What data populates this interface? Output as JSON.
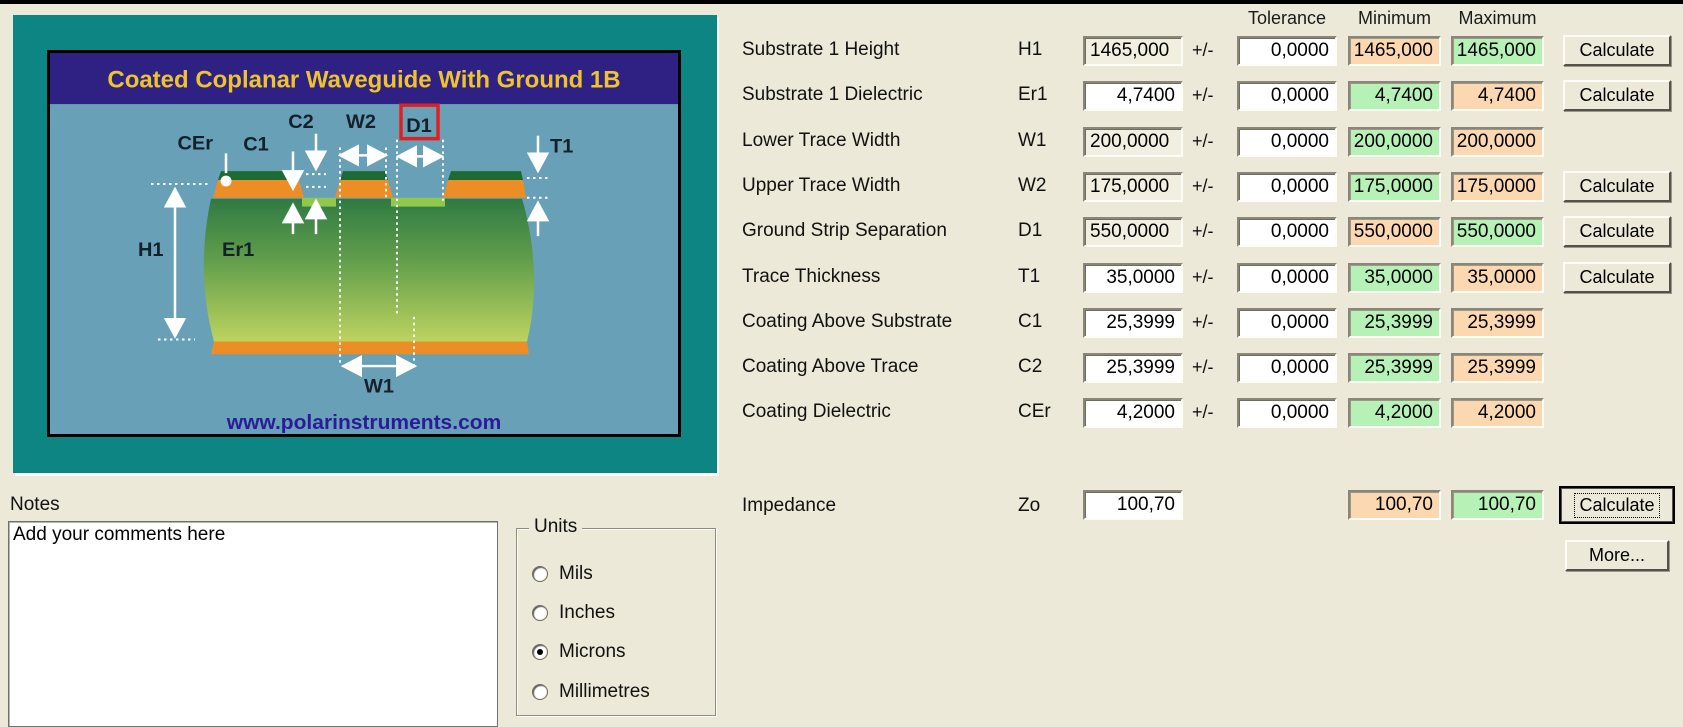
{
  "diagram": {
    "title": "Coated Coplanar Waveguide With Ground 1B",
    "website": "www.polarinstruments.com",
    "labels": {
      "cer": "CEr",
      "c1": "C1",
      "c2": "C2",
      "w2": "W2",
      "d1": "D1",
      "t1": "T1",
      "h1": "H1",
      "er1": "Er1",
      "w1": "W1"
    },
    "colors": {
      "frame_teal": "#0d8583",
      "title_bar_navy": "#2e2183",
      "title_text_gold": "#eec42e",
      "panel_blue": "#68a0b8",
      "coating_dark_green": "#1d6b33",
      "copper_orange": "#ec8d26",
      "substrate_green_top": "#2f7a43",
      "substrate_green_bottom": "#bdd35f",
      "valley_green": "#90c84d",
      "d1_highlight_red": "#e02020",
      "website_blue": "#2b1b9b"
    }
  },
  "columns": {
    "tolerance": "Tolerance",
    "minimum": "Minimum",
    "maximum": "Maximum"
  },
  "plusminus": "+/-",
  "calculate_label": "Calculate",
  "rows": [
    {
      "label": "Substrate 1 Height",
      "symbol": "H1",
      "value": "1465,000",
      "value_style": "filled",
      "tolerance": "0,0000",
      "min": "1465,000",
      "max": "1465,000",
      "min_color": "peach",
      "max_color": "green",
      "calculate": true
    },
    {
      "label": "Substrate 1 Dielectric",
      "symbol": "Er1",
      "value": "4,7400",
      "value_style": "white",
      "tolerance": "0,0000",
      "min": "4,7400",
      "max": "4,7400",
      "min_color": "green",
      "max_color": "peach",
      "calculate": true
    },
    {
      "label": "Lower Trace Width",
      "symbol": "W1",
      "value": "200,0000",
      "value_style": "filled",
      "tolerance": "0,0000",
      "min": "200,0000",
      "max": "200,0000",
      "min_color": "green",
      "max_color": "peach",
      "calculate": false
    },
    {
      "label": "Upper Trace Width",
      "symbol": "W2",
      "value": "175,0000",
      "value_style": "filled",
      "tolerance": "0,0000",
      "min": "175,0000",
      "max": "175,0000",
      "min_color": "green",
      "max_color": "peach",
      "calculate": true
    },
    {
      "label": "Ground Strip Separation",
      "symbol": "D1",
      "value": "550,0000",
      "value_style": "filled",
      "tolerance": "0,0000",
      "min": "550,0000",
      "max": "550,0000",
      "min_color": "peach",
      "max_color": "green",
      "calculate": true
    },
    {
      "label": "Trace Thickness",
      "symbol": "T1",
      "value": "35,0000",
      "value_style": "white",
      "tolerance": "0,0000",
      "min": "35,0000",
      "max": "35,0000",
      "min_color": "green",
      "max_color": "peach",
      "calculate": true
    },
    {
      "label": "Coating Above Substrate",
      "symbol": "C1",
      "value": "25,3999",
      "value_style": "white",
      "tolerance": "0,0000",
      "min": "25,3999",
      "max": "25,3999",
      "min_color": "green",
      "max_color": "peach",
      "calculate": false
    },
    {
      "label": "Coating Above Trace",
      "symbol": "C2",
      "value": "25,3999",
      "value_style": "white",
      "tolerance": "0,0000",
      "min": "25,3999",
      "max": "25,3999",
      "min_color": "green",
      "max_color": "peach",
      "calculate": false
    },
    {
      "label": "Coating Dielectric",
      "symbol": "CEr",
      "value": "4,2000",
      "value_style": "white",
      "tolerance": "0,0000",
      "min": "4,2000",
      "max": "4,2000",
      "min_color": "green",
      "max_color": "peach",
      "calculate": false
    }
  ],
  "impedance": {
    "label": "Impedance",
    "symbol": "Zo",
    "value": "100,70",
    "min": "100,70",
    "max": "100,70",
    "min_color": "peach",
    "max_color": "green",
    "calculate_label": "Calculate",
    "more_label": "More..."
  },
  "notes": {
    "label": "Notes",
    "text": "Add your comments here"
  },
  "units": {
    "label": "Units",
    "options": [
      {
        "label": "Mils",
        "selected": false
      },
      {
        "label": "Inches",
        "selected": false
      },
      {
        "label": "Microns",
        "selected": true
      },
      {
        "label": "Millimetres",
        "selected": false
      }
    ]
  }
}
